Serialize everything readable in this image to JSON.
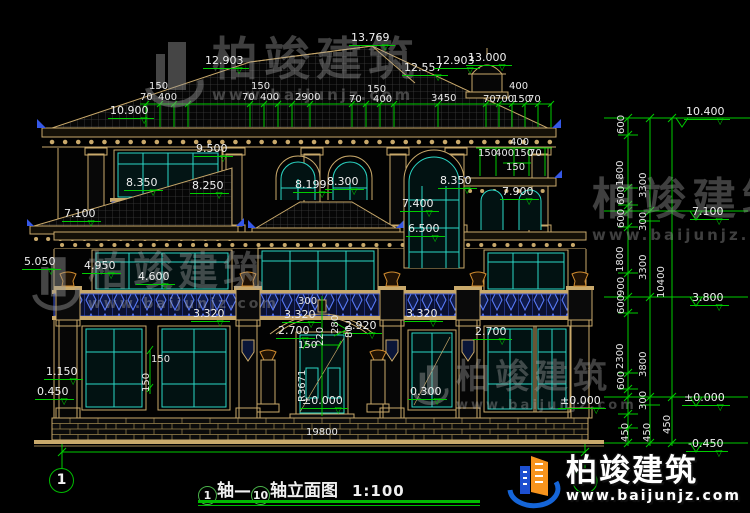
{
  "watermark": {
    "brand": "柏竣建筑",
    "url": "www.baijunjz.com"
  },
  "footer_logo": {
    "brand": "柏竣建筑",
    "url": "www.baijunjz.com"
  },
  "drawing": {
    "title": {
      "axis_start": "1",
      "axis_sep": "轴—",
      "axis_end": "10",
      "suffix": "轴立面图",
      "scale": "1:100"
    },
    "axis_bubbles": {
      "left": "1"
    }
  },
  "elevation_markers": [
    {
      "v": "13.769",
      "x": 349,
      "y": 26
    },
    {
      "v": "12.903",
      "x": 203,
      "y": 49
    },
    {
      "v": "12.557",
      "x": 402,
      "y": 56
    },
    {
      "v": "12.903",
      "x": 434,
      "y": 49
    },
    {
      "v": "13.000",
      "x": 466,
      "y": 46
    },
    {
      "v": "10.900",
      "x": 108,
      "y": 99
    },
    {
      "v": "9.500",
      "x": 194,
      "y": 137
    },
    {
      "v": "8.350",
      "x": 124,
      "y": 171
    },
    {
      "v": "8.250",
      "x": 190,
      "y": 174
    },
    {
      "v": "8.199",
      "x": 293,
      "y": 173
    },
    {
      "v": "8.300",
      "x": 325,
      "y": 170
    },
    {
      "v": "8.350",
      "x": 438,
      "y": 169
    },
    {
      "v": "7.900",
      "x": 500,
      "y": 180
    },
    {
      "v": "7.400",
      "x": 400,
      "y": 192
    },
    {
      "v": "7.100",
      "x": 62,
      "y": 202
    },
    {
      "v": "6.500",
      "x": 406,
      "y": 217
    },
    {
      "v": "5.050",
      "x": 22,
      "y": 250
    },
    {
      "v": "4.950",
      "x": 82,
      "y": 254
    },
    {
      "v": "4.600",
      "x": 136,
      "y": 265
    },
    {
      "v": "3.320",
      "x": 191,
      "y": 302
    },
    {
      "v": "3.320",
      "x": 282,
      "y": 303
    },
    {
      "v": "3.320",
      "x": 404,
      "y": 302
    },
    {
      "v": "2.920",
      "x": 343,
      "y": 314
    },
    {
      "v": "2.700",
      "x": 276,
      "y": 319
    },
    {
      "v": "2.700",
      "x": 473,
      "y": 320
    },
    {
      "v": "1.150",
      "x": 44,
      "y": 360
    },
    {
      "v": "0.450",
      "x": 35,
      "y": 380
    },
    {
      "v": "0.300",
      "x": 408,
      "y": 380
    },
    {
      "v": "±0.000",
      "x": 300,
      "y": 389
    },
    {
      "v": "±0.000",
      "x": 558,
      "y": 389
    },
    {
      "v": "10.400",
      "x": 684,
      "y": 100
    },
    {
      "v": "7.100",
      "x": 690,
      "y": 200
    },
    {
      "v": "3.800",
      "x": 690,
      "y": 286
    },
    {
      "v": "±0.000",
      "x": 682,
      "y": 386
    },
    {
      "v": "-0.450",
      "x": 686,
      "y": 432
    }
  ],
  "dim_labels": [
    {
      "v": "150",
      "x": 149,
      "y": 81
    },
    {
      "v": "70",
      "x": 140,
      "y": 92
    },
    {
      "v": "400",
      "x": 158,
      "y": 92
    },
    {
      "v": "150",
      "x": 251,
      "y": 81
    },
    {
      "v": "70",
      "x": 242,
      "y": 92
    },
    {
      "v": "400",
      "x": 260,
      "y": 92
    },
    {
      "v": "2900",
      "x": 295,
      "y": 92
    },
    {
      "v": "150",
      "x": 367,
      "y": 84
    },
    {
      "v": "70",
      "x": 349,
      "y": 94
    },
    {
      "v": "400",
      "x": 373,
      "y": 94
    },
    {
      "v": "3450",
      "x": 431,
      "y": 93
    },
    {
      "v": "400",
      "x": 509,
      "y": 81
    },
    {
      "v": "70",
      "x": 483,
      "y": 94
    },
    {
      "v": "700",
      "x": 495,
      "y": 94
    },
    {
      "v": "150",
      "x": 512,
      "y": 94
    },
    {
      "v": "70",
      "x": 528,
      "y": 94
    },
    {
      "v": "400",
      "x": 510,
      "y": 137
    },
    {
      "v": "150",
      "x": 478,
      "y": 148
    },
    {
      "v": "400",
      "x": 495,
      "y": 148
    },
    {
      "v": "150",
      "x": 514,
      "y": 148
    },
    {
      "v": "70",
      "x": 529,
      "y": 148
    },
    {
      "v": "150",
      "x": 506,
      "y": 162
    },
    {
      "v": "300",
      "x": 298,
      "y": 296
    },
    {
      "v": "150",
      "x": 298,
      "y": 340
    },
    {
      "v": "150",
      "x": 151,
      "y": 354
    },
    {
      "v": "19800",
      "x": 306,
      "y": 427
    },
    {
      "v": "220",
      "x": 315,
      "y": 346,
      "rot": 1
    },
    {
      "v": "280",
      "x": 330,
      "y": 334,
      "rot": 1
    },
    {
      "v": "80",
      "x": 344,
      "y": 338,
      "rot": 1
    },
    {
      "v": "R3671",
      "x": 297,
      "y": 402,
      "rot": 1
    },
    {
      "v": "150",
      "x": 141,
      "y": 392,
      "rot": 1
    },
    {
      "v": "600",
      "x": 616,
      "y": 134,
      "rot": 1
    },
    {
      "v": "1800",
      "x": 615,
      "y": 186,
      "rot": 1
    },
    {
      "v": "600",
      "x": 616,
      "y": 205,
      "rot": 1
    },
    {
      "v": "300",
      "x": 638,
      "y": 231,
      "rot": 1
    },
    {
      "v": "600",
      "x": 616,
      "y": 228,
      "rot": 1
    },
    {
      "v": "1800",
      "x": 615,
      "y": 272,
      "rot": 1
    },
    {
      "v": "900",
      "x": 616,
      "y": 296,
      "rot": 1
    },
    {
      "v": "3300",
      "x": 638,
      "y": 198,
      "rot": 1
    },
    {
      "v": "3300",
      "x": 638,
      "y": 280,
      "rot": 1
    },
    {
      "v": "600",
      "x": 616,
      "y": 314,
      "rot": 1
    },
    {
      "v": "2300",
      "x": 615,
      "y": 369,
      "rot": 1
    },
    {
      "v": "600",
      "x": 616,
      "y": 390,
      "rot": 1
    },
    {
      "v": "300",
      "x": 638,
      "y": 410,
      "rot": 1
    },
    {
      "v": "3800",
      "x": 638,
      "y": 377,
      "rot": 1
    },
    {
      "v": "450",
      "x": 620,
      "y": 442,
      "rot": 1
    },
    {
      "v": "450",
      "x": 642,
      "y": 442,
      "rot": 1
    },
    {
      "v": "450",
      "x": 662,
      "y": 434,
      "rot": 1
    },
    {
      "v": "10400",
      "x": 656,
      "y": 298,
      "rot": 1
    }
  ]
}
